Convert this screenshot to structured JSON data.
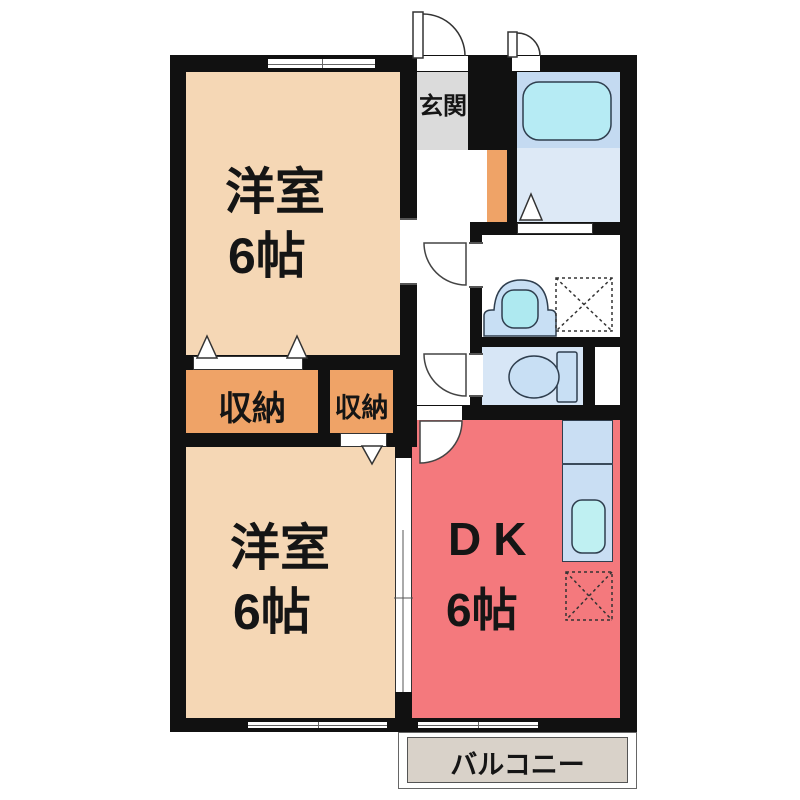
{
  "plan": {
    "rooms": {
      "western_room_top": {
        "name": "洋室",
        "size": "6帖"
      },
      "western_room_bottom": {
        "name": "洋室",
        "size": "6帖"
      },
      "dining_kitchen": {
        "name": "DK",
        "size": "6帖"
      },
      "entrance": {
        "label": "玄関"
      },
      "closet_large": {
        "label": "収納"
      },
      "closet_small": {
        "label": "収納"
      },
      "balcony": {
        "label": "バルコニー"
      }
    },
    "icons": [
      "bathtub-icon",
      "bath-folding-door-icon",
      "washbasin-icon",
      "washing-machine-space-icon",
      "toilet-icon",
      "kitchen-sink-icon",
      "refrigerator-space-icon",
      "door-swing-icon",
      "closet-folding-door-icon",
      "window-icon",
      "sliding-door-icon"
    ],
    "colors": {
      "wall": "#111111",
      "western_room": "#F5D7B5",
      "closet": "#EFA367",
      "dining_kitchen": "#F4797D",
      "entrance_floor": "#DBDBDB",
      "balcony_floor": "#D9D2C9",
      "bath_upper": "#C4DAF1",
      "bath_floor": "#DDE9F6",
      "bathtub": "#B6EBF4",
      "toilet_floor": "#D7E6F6",
      "fixture_blue": "#C8DFF4",
      "sink_cyan": "#BFF0F2"
    }
  }
}
